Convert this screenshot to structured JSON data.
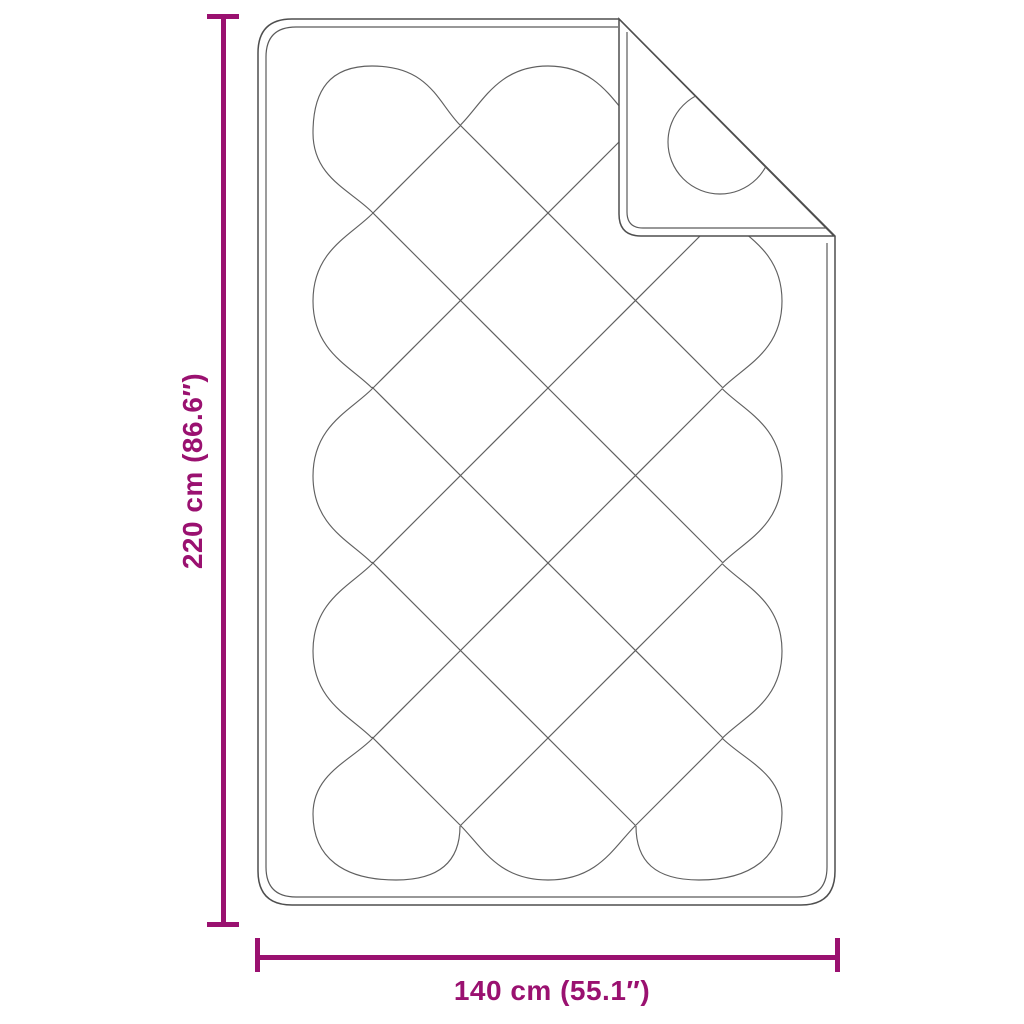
{
  "diagram": {
    "vertical_dimension": {
      "label": "220 cm (86.6″)",
      "value_cm": 220,
      "value_inches": 86.6
    },
    "horizontal_dimension": {
      "label": "140 cm (55.1″)",
      "value_cm": 140,
      "value_inches": 55.1
    },
    "colors": {
      "dimension_accent": "#9a1170",
      "drawing_line": "#5a5a5a",
      "background": "#ffffff"
    }
  }
}
